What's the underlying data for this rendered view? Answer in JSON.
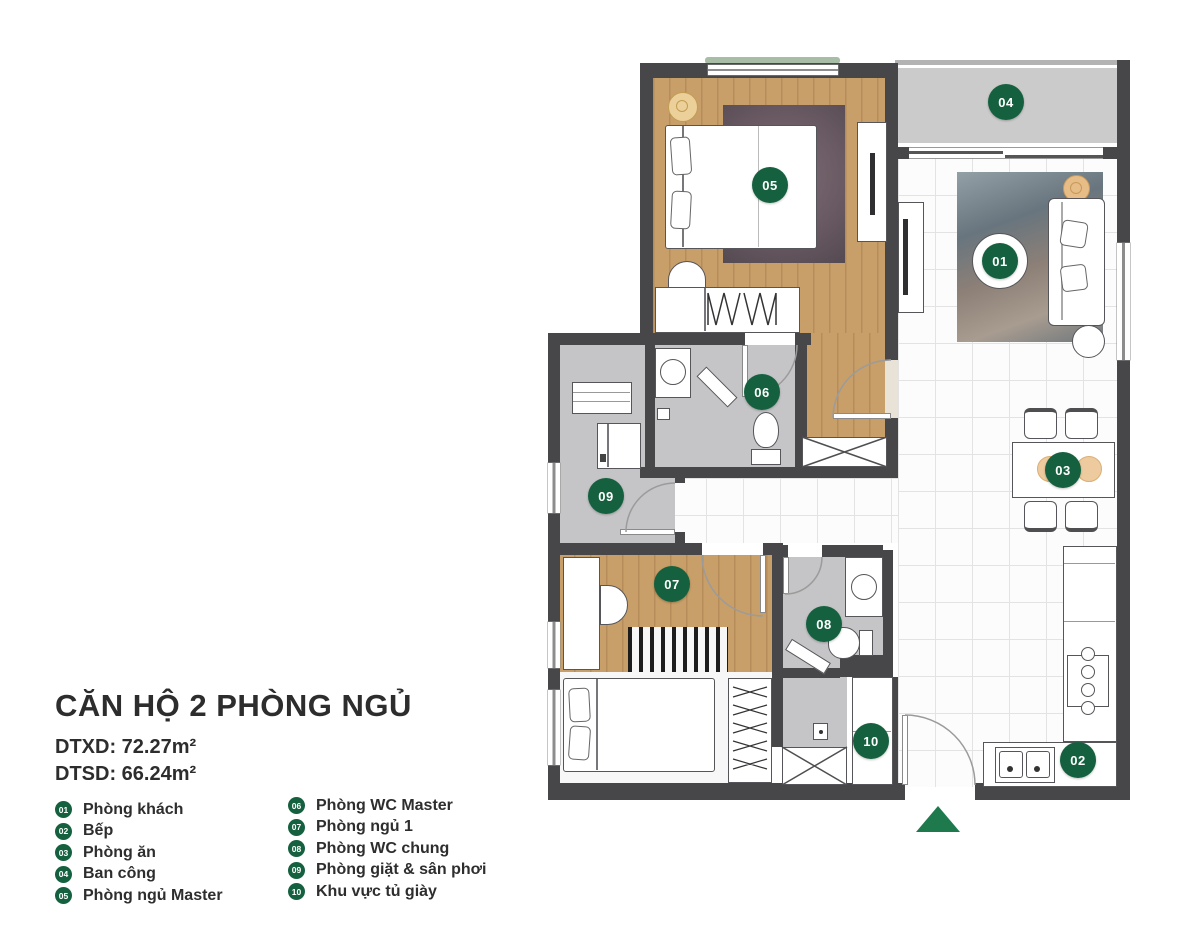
{
  "header": {
    "title": "CĂN HỘ 2 PHÒNG NGỦ",
    "areas": [
      {
        "label": "DTXD:",
        "value": "72.27m²"
      },
      {
        "label": "DTSD:",
        "value": "66.24m²"
      }
    ]
  },
  "legend": {
    "columns": [
      [
        {
          "num": "01",
          "label": "Phòng khách"
        },
        {
          "num": "02",
          "label": "Bếp"
        },
        {
          "num": "03",
          "label": "Phòng ăn"
        },
        {
          "num": "04",
          "label": "Ban công"
        },
        {
          "num": "05",
          "label": "Phòng ngủ Master"
        }
      ],
      [
        {
          "num": "06",
          "label": "Phòng WC Master"
        },
        {
          "num": "07",
          "label": "Phòng ngủ 1"
        },
        {
          "num": "08",
          "label": "Phòng WC chung"
        },
        {
          "num": "09",
          "label": "Phòng giặt & sân phơi"
        },
        {
          "num": "10",
          "label": "Khu vực tủ giày"
        }
      ]
    ]
  },
  "plan": {
    "badges": [
      {
        "num": "01",
        "cx": 455,
        "cy": 206
      },
      {
        "num": "02",
        "cx": 533,
        "cy": 705
      },
      {
        "num": "03",
        "cx": 518,
        "cy": 415
      },
      {
        "num": "04",
        "cx": 461,
        "cy": 47
      },
      {
        "num": "05",
        "cx": 225,
        "cy": 130
      },
      {
        "num": "06",
        "cx": 217,
        "cy": 337
      },
      {
        "num": "07",
        "cx": 127,
        "cy": 529
      },
      {
        "num": "08",
        "cx": 279,
        "cy": 569
      },
      {
        "num": "09",
        "cx": 61,
        "cy": 441
      },
      {
        "num": "10",
        "cx": 326,
        "cy": 686
      }
    ]
  },
  "colors": {
    "badge_green": "#15613f",
    "entrance_arrow_green": "#1e7a4c",
    "wall": "#47474a",
    "wood_floor": "#c89f68",
    "wet_area_floor": "#c5c5c7",
    "balcony_floor": "#cbcbcb"
  }
}
